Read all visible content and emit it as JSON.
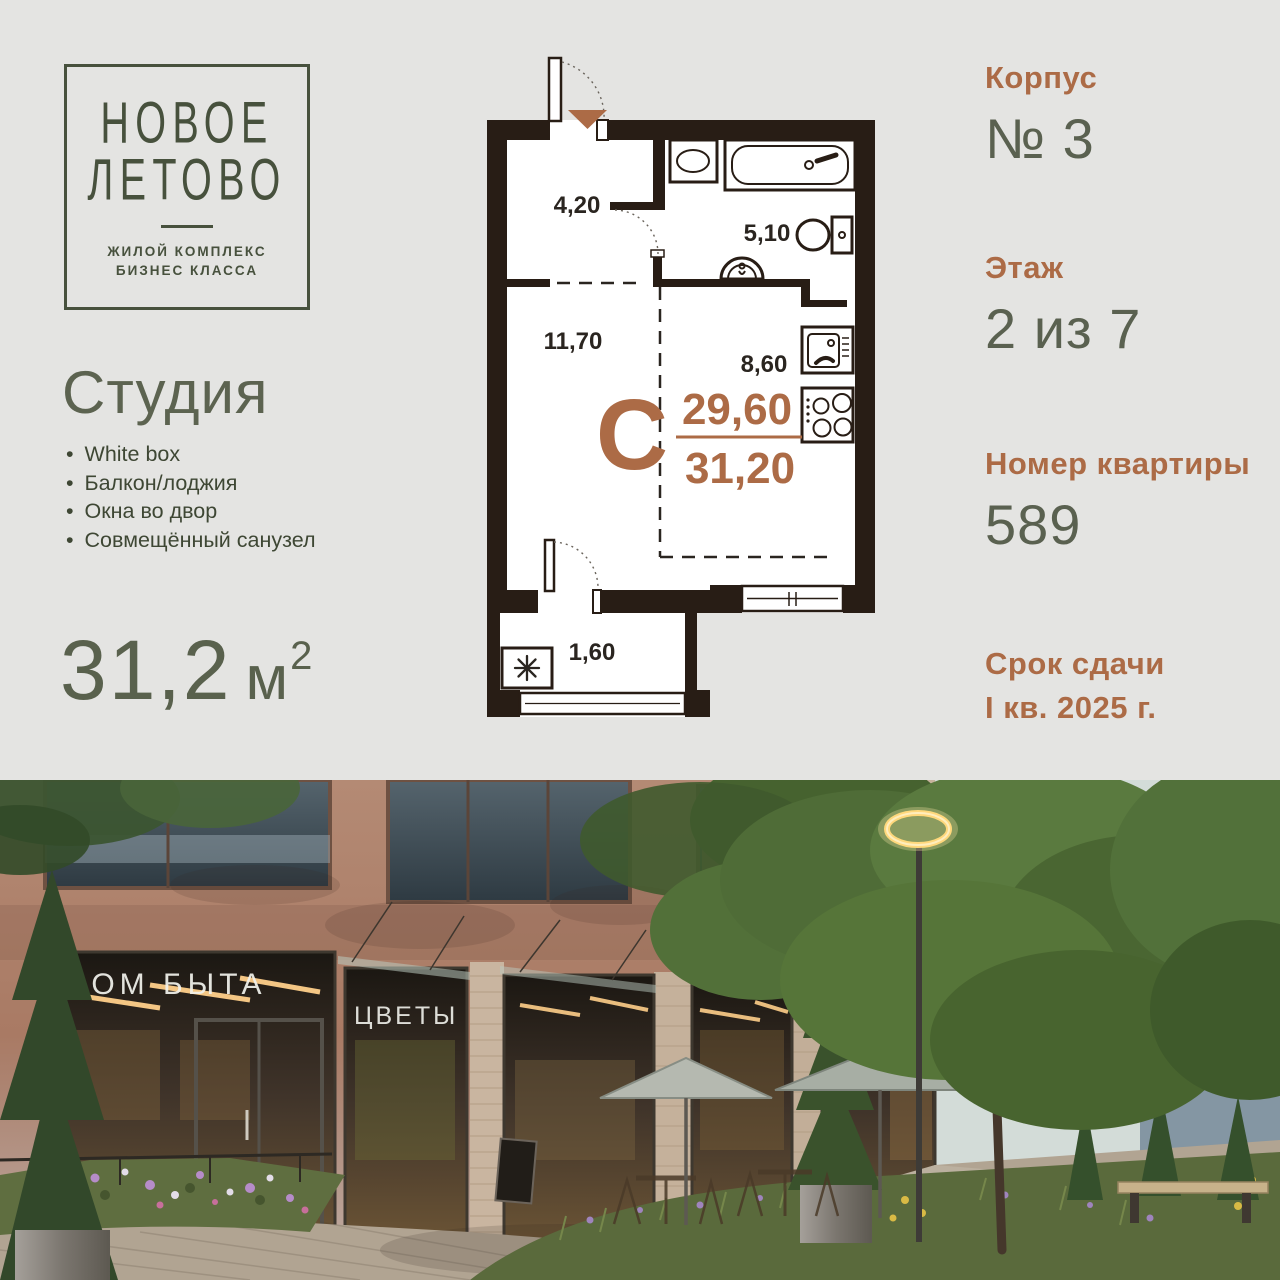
{
  "logo": {
    "title_line1": "НОВОЕ",
    "title_line2": "ЛЕТОВО",
    "subtitle_line1": "ЖИЛОЙ КОМПЛЕКС",
    "subtitle_line2": "БИЗНЕС КЛАССА"
  },
  "apartment": {
    "type_title": "Студия",
    "features": [
      "White box",
      "Балкон/лоджия",
      "Окна во двор",
      "Совмещённый санузел"
    ],
    "area_value": "31,2",
    "area_unit": "м",
    "area_sup": "2"
  },
  "plan": {
    "type_letter": "С",
    "area_upper": "29,60",
    "area_lower": "31,20",
    "labels": {
      "hall": "4,20",
      "bathroom": "5,10",
      "living": "11,70",
      "kitchen": "8,60",
      "balcony": "1,60"
    }
  },
  "details": [
    {
      "label": "Корпус",
      "value": "№ 3"
    },
    {
      "label": "Этаж",
      "value": "2 из 7"
    },
    {
      "label": "Номер квартиры",
      "value": "589"
    },
    {
      "label": "Срок сдачи",
      "value": "I кв. 2025 г."
    }
  ],
  "photo": {
    "signs": {
      "dom_byta": "ДОМ БЫТА",
      "cvety": "ЦВЕТЫ",
      "kafe": "КАФЕ"
    }
  },
  "colors": {
    "accent_orange": "#ac6b46",
    "logo_green": "#47513d",
    "text_olive": "#59614d",
    "wall_dark": "#281d15",
    "background": "#e4e4e2"
  }
}
